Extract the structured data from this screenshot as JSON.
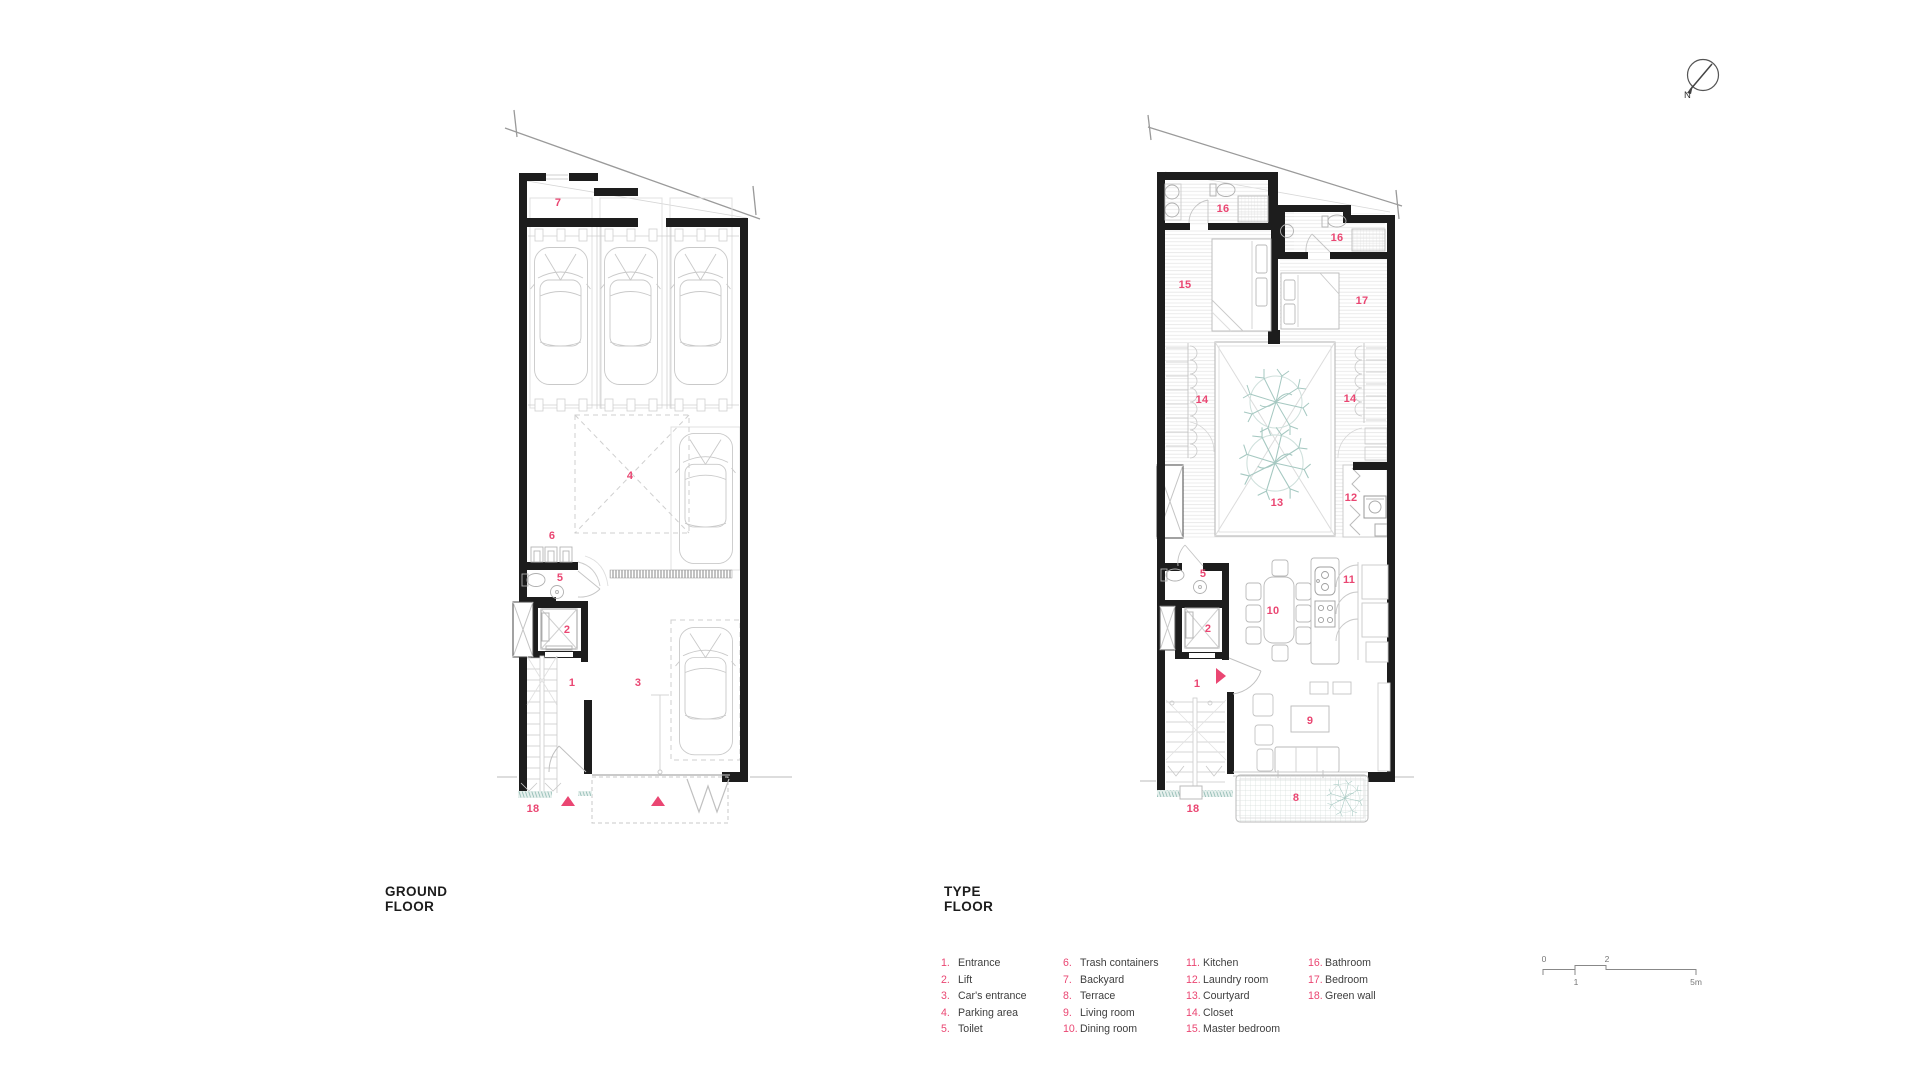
{
  "plans": {
    "ground": {
      "title_line1": "GROUND",
      "title_line2": "FLOOR",
      "labels": [
        "7",
        "4",
        "6",
        "5",
        "2",
        "1",
        "3",
        "18"
      ]
    },
    "type": {
      "title_line1": "TYPE",
      "title_line2": "FLOOR",
      "labels": [
        "16",
        "16",
        "15",
        "17",
        "14",
        "14",
        "13",
        "12",
        "5",
        "10",
        "11",
        "2",
        "1",
        "9",
        "8",
        "18"
      ]
    }
  },
  "legend": {
    "items": [
      {
        "num": "1.",
        "label": "Entrance"
      },
      {
        "num": "2.",
        "label": "Lift"
      },
      {
        "num": "3.",
        "label": "Car's entrance"
      },
      {
        "num": "4.",
        "label": "Parking area"
      },
      {
        "num": "5.",
        "label": "Toilet"
      },
      {
        "num": "6.",
        "label": "Trash containers"
      },
      {
        "num": "7.",
        "label": "Backyard"
      },
      {
        "num": "8.",
        "label": "Terrace"
      },
      {
        "num": "9.",
        "label": "Living room"
      },
      {
        "num": "10.",
        "label": "Dining room"
      },
      {
        "num": "11.",
        "label": "Kitchen"
      },
      {
        "num": "12.",
        "label": "Laundry room"
      },
      {
        "num": "13.",
        "label": "Courtyard"
      },
      {
        "num": "14.",
        "label": "Closet"
      },
      {
        "num": "15.",
        "label": "Master bedroom"
      },
      {
        "num": "16.",
        "label": "Bathroom"
      },
      {
        "num": "17.",
        "label": "Bedroom"
      },
      {
        "num": "18.",
        "label": "Green wall"
      }
    ]
  },
  "scale_bar": {
    "ticks": [
      "0",
      "1",
      "2",
      "5m"
    ]
  },
  "compass": {
    "label": "N"
  },
  "colors": {
    "accent_pink": "#ea4672",
    "plant_teal": "#a5c8c1",
    "wall_black": "#1d1d1d",
    "green_wall": "#8cb8b0"
  }
}
